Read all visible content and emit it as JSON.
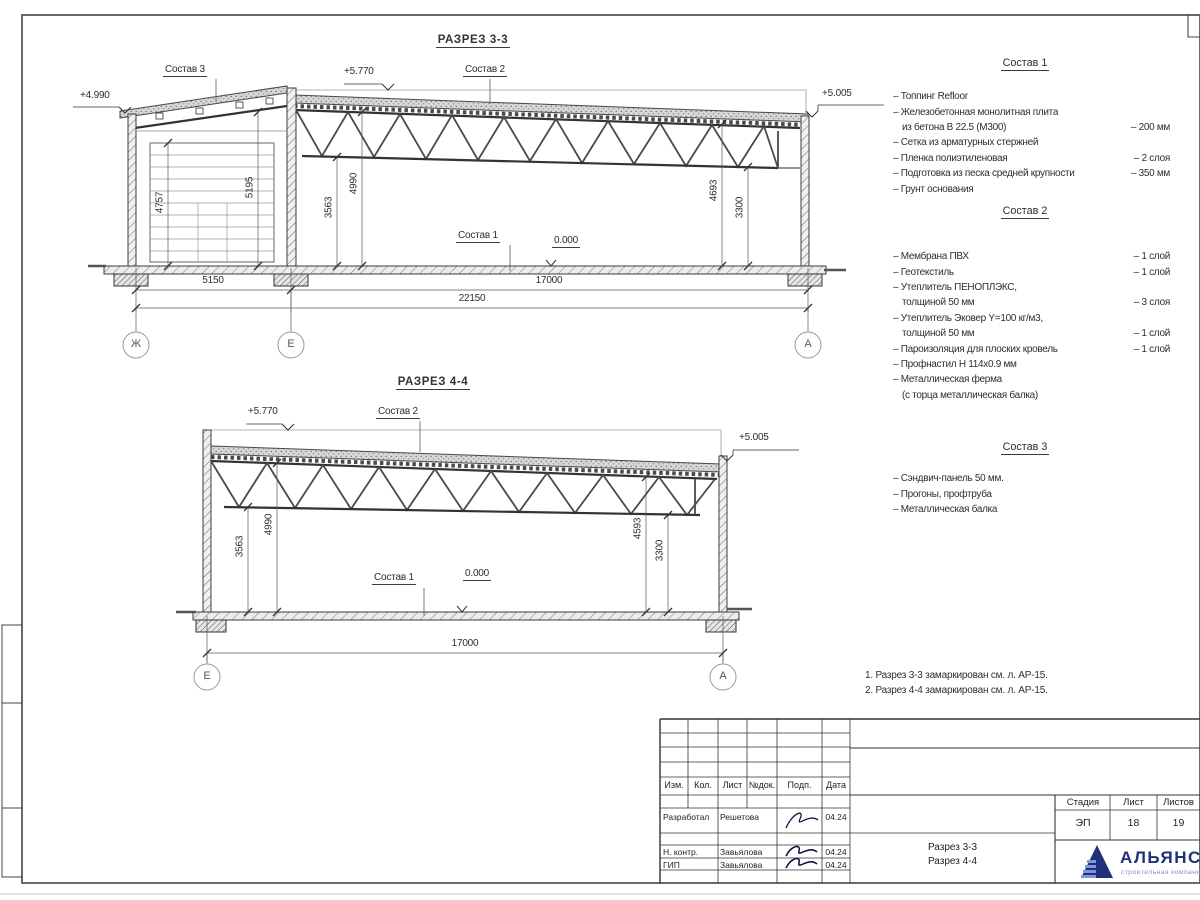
{
  "sections": {
    "s33": {
      "title": "РАЗРЕЗ 3-3",
      "labels": {
        "sostav3": "Состав 3",
        "sostav2": "Состав 2",
        "sostav1": "Состав 1",
        "zero": "0.000"
      },
      "elevations": {
        "left": "+4.990",
        "mid": "+5.770",
        "right": "+5.005"
      },
      "dims": {
        "v4757": "4757",
        "v5195": "5195",
        "v3563": "3563",
        "v4990": "4990",
        "v4693": "4693",
        "v3300": "3300",
        "h5150": "5150",
        "h17000": "17000",
        "h22150": "22150"
      },
      "axes": [
        "Ж",
        "Е",
        "А"
      ]
    },
    "s44": {
      "title": "РАЗРЕЗ 4-4",
      "labels": {
        "sostav2": "Состав 2",
        "sostav1": "Состав 1",
        "zero": "0.000"
      },
      "elevations": {
        "left": "+5.770",
        "right": "+5.005"
      },
      "dims": {
        "v3563": "3563",
        "v4990": "4990",
        "v4593": "4593",
        "v3300": "3300",
        "h17000": "17000"
      },
      "axes": [
        "Е",
        "А"
      ]
    }
  },
  "compositions": {
    "c1": {
      "title": "Состав 1",
      "items": [
        {
          "text": "– Топпинг Refloor",
          "value": ""
        },
        {
          "text": "– Железобетонная  монолитная плита",
          "value": ""
        },
        {
          "text": "из бетона В 22.5 (М300)",
          "value": "– 200 мм"
        },
        {
          "text": "– Сетка из арматурных стержней",
          "value": ""
        },
        {
          "text": "– Пленка полиэтиленовая",
          "value": "– 2 слоя"
        },
        {
          "text": "– Подготовка из песка средней крупности",
          "value": "– 350 мм"
        },
        {
          "text": "– Грунт основания",
          "value": ""
        }
      ]
    },
    "c2": {
      "title": "Состав 2",
      "items": [
        {
          "text": "– Мембрана ПВХ",
          "value": "– 1 слой"
        },
        {
          "text": "– Геотекстиль",
          "value": "– 1 слой"
        },
        {
          "text": "– Утеплитель ПЕНОПЛЭКС,",
          "value": ""
        },
        {
          "text": "толщиной 50 мм",
          "value": "– 3 слоя"
        },
        {
          "text": "– Утеплитель Эковер Y=100 кг/м3,",
          "value": ""
        },
        {
          "text": "толщиной 50 мм",
          "value": "– 1 слой"
        },
        {
          "text": "– Пароизоляция для плоских кровель",
          "value": "– 1 слой"
        },
        {
          "text": "– Профнастил Н 114х0.9 мм",
          "value": ""
        },
        {
          "text": "– Металлическая ферма",
          "value": ""
        },
        {
          "text": "(с торца металлическая балка)",
          "value": ""
        }
      ]
    },
    "c3": {
      "title": "Состав 3",
      "items": [
        {
          "text": "– Сэндвич-панель 50 мм.",
          "value": ""
        },
        {
          "text": "– Прогоны, профтруба",
          "value": ""
        },
        {
          "text": "– Металлическая балка",
          "value": ""
        }
      ]
    }
  },
  "notes": [
    "1. Разрез 3-3 замаркирован см. л. АР-15.",
    "2. Разрез 4-4 замаркирован см. л. АР-15."
  ],
  "titleblock": {
    "cols": [
      "Изм.",
      "Кол.",
      "Лист",
      "№док.",
      "Подп.",
      "Дата"
    ],
    "rows": [
      {
        "role": "Разработал",
        "name": "Решетова",
        "date": "04.24"
      },
      {
        "role": "Н. контр.",
        "name": "Завьялова",
        "date": "04.24"
      },
      {
        "role": "ГИП",
        "name": "Завьялова",
        "date": "04.24"
      }
    ],
    "stage_cols": [
      "Стадия",
      "Лист",
      "Листов"
    ],
    "stage_vals": [
      "ЭП",
      "18",
      "19"
    ],
    "doc": [
      "Разрез 3-3",
      "Разрез 4-4"
    ],
    "company": {
      "name": "АЛЬЯНС",
      "subtitle": "строительная компания"
    },
    "colors": {
      "brand": "#20307a",
      "brand_light": "#8191cc"
    }
  }
}
